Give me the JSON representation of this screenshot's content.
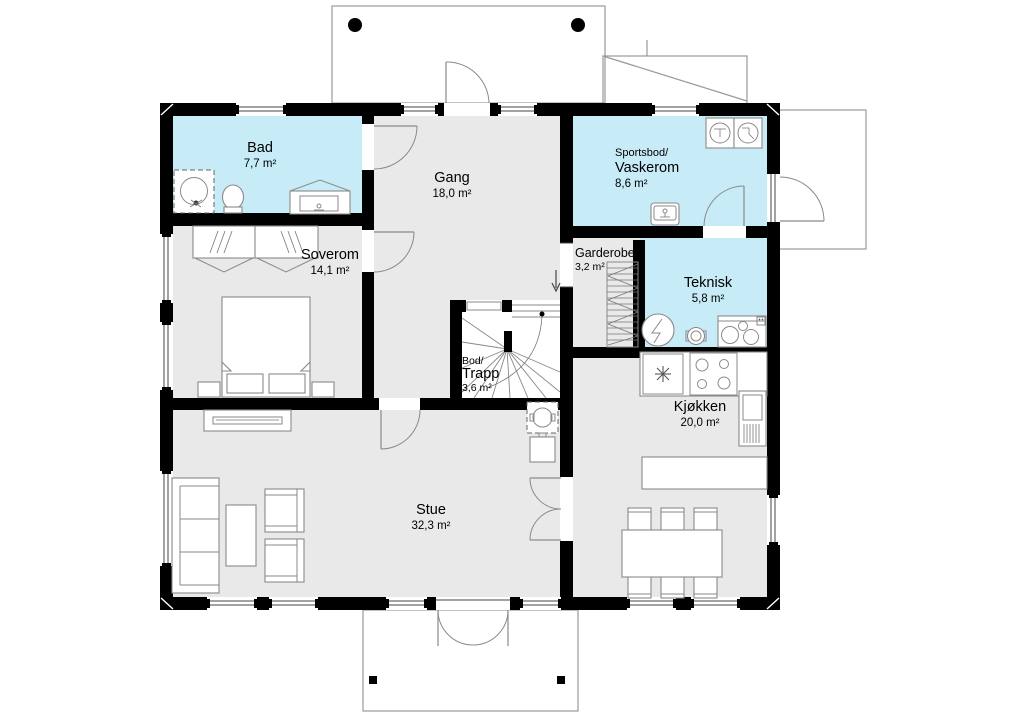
{
  "plan_title": "First floor plan",
  "rooms": {
    "bad": {
      "name": "Bad",
      "area": "7,7 m²"
    },
    "gang": {
      "name": "Gang",
      "area": "18,0 m²"
    },
    "vaskerom": {
      "name_line1": "Sportsbod/",
      "name_line2": "Vaskerom",
      "area": "8,6 m²"
    },
    "soverom": {
      "name": "Soverom",
      "area": "14,1 m²"
    },
    "garderobe": {
      "name": "Garderobe",
      "area": "3,2 m²"
    },
    "teknisk": {
      "name": "Teknisk",
      "area": "5,8 m²"
    },
    "trapp": {
      "name_line1": "Bod/",
      "name_line2": "Trapp",
      "area": "3,6 m²"
    },
    "kjokken": {
      "name": "Kjøkken",
      "area": "20,0 m²"
    },
    "stue": {
      "name": "Stue",
      "area": "32,3 m²"
    }
  },
  "colors": {
    "wet_room": "#c7ecf8",
    "dry_room": "#e9e9e9",
    "wall": "#000000",
    "exterior_outline": "#9a9a9a"
  },
  "symbols": {
    "stair_direction": "down"
  }
}
